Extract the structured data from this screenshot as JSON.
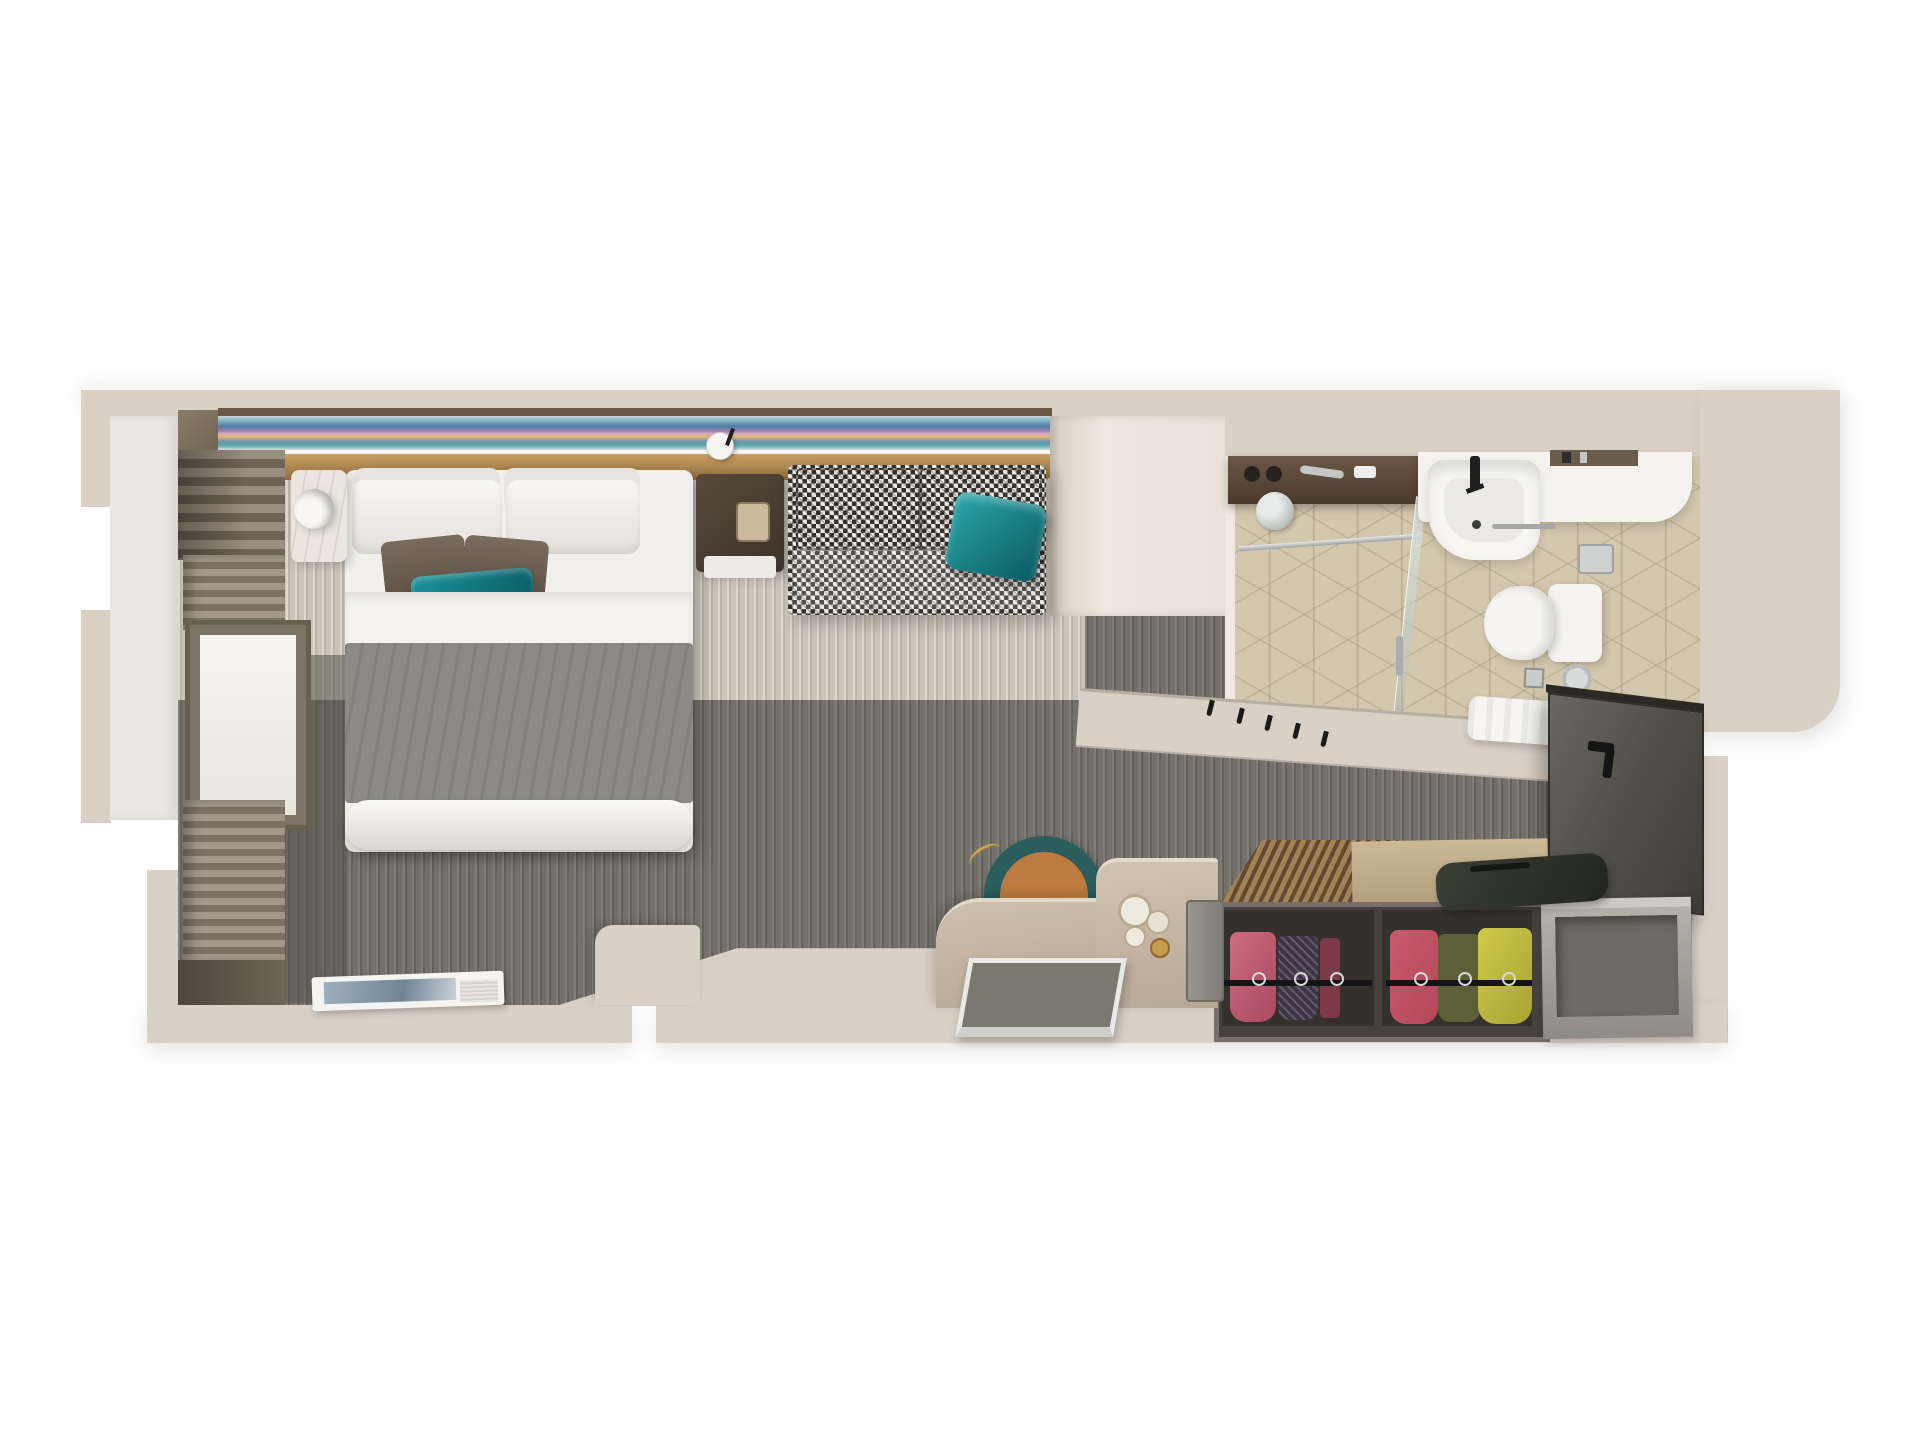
{
  "image_kind": "3d-top-down-floorplan-render",
  "subject": "stateroom-cabin-with-bathroom",
  "palette": {
    "bg": "#ffffff",
    "wall": "#d9d1c6",
    "wall_edge": "#b7aea0",
    "balcony": "#eae8e4",
    "divider": "#e9e2d8",
    "art_trim": "#6b5843",
    "gold_hi": "#c9a166",
    "gold_lo": "#926e3e",
    "art1": "#c8d8dd",
    "art2": "#7fb3c2",
    "art3": "#4f7ea8",
    "art4": "#9b7fb0",
    "art5": "#e3b873",
    "art6": "#58a8a8",
    "carpet_light": "#cbc4b8",
    "carpet_dark": "#74716a",
    "carpet_deep": "#56534c",
    "bed_white": "#f1f0ed",
    "sheet": "#f4f3f0",
    "duvet": "#8b8a86",
    "pillow_shade": "#e7e5e0",
    "accent_hi": "#7a6c5d",
    "accent_lo": "#5f5346",
    "accent_teal_edge": "#10454b",
    "teal_hi": "#18939b",
    "teal_lo": "#0a5860",
    "hound_dark": "#34312d",
    "hound_light": "#eae8e2",
    "wood_dark_hi": "#57493c",
    "wood_dark_lo": "#3e332a",
    "marble": "#ebe7e0",
    "taupe": "#8d8274",
    "curtain_hi": "#a3988a",
    "curtain_lo": "#7d7263",
    "window_frame": "#7d7468",
    "window_glow": "#f6f4ef",
    "tile": "#d3c7ad",
    "fixture": "#f4f3f0",
    "chrome": "#c3c6c4",
    "ink": "#1f1f1f",
    "shelf_wood_hi": "#6a5746",
    "shelf_wood_lo": "#4a3a2c",
    "door_hi": "#6a6661",
    "door_lo": "#3f3d39",
    "wood_floor": "#cf9f6f",
    "slat_hi": "#a18257",
    "slat_lo": "#64492f",
    "wardrobe_frame": "#767068",
    "wardrobe_box": "#44403b",
    "wardrobe_interior": "#34312d",
    "cloth_pink_hi": "#cf6b80",
    "cloth_pink_lo": "#a84a5e",
    "cloth_dark": "#3d3545",
    "cloth_maroon": "#7c3a46",
    "cloth_red": "#b5475a",
    "cloth_olive": "#5d6036",
    "cloth_yellow_hi": "#d1ca4c",
    "cloth_yellow_lo": "#a8a233",
    "rail": "#141317",
    "bench_hi": "#b4b1ab",
    "bench_lo": "#8f8c86",
    "bench_rim": "#cdcac4",
    "bench_inner": "#6e6b67",
    "bag_hi": "#3a3e33",
    "bag_lo": "#22251e",
    "desk_hi": "#cfc0ae",
    "desk_lo": "#b3a391",
    "desk_edge": "#e2d8ca",
    "stool_teal": "#2a5d5c",
    "stool_orange": "#bd7b40",
    "gold_accent": "#caa24e",
    "tray_frame": "#e9e9e7",
    "tray_inner": "#7b786f",
    "step": "#d9d1c5",
    "book_blue_hi": "#9db0c0",
    "book_blue_lo": "#6f8699",
    "towel": "#f6f5f1"
  },
  "scene": {
    "bedroom": [
      "art-headboard-strip",
      "gold-headboard-band",
      "double-bed",
      "white-pillows",
      "accent-pillows",
      "teal-throw-pillows",
      "gray-duvet",
      "marble-nightstand",
      "round-lamp",
      "dark-wood-nightstand",
      "phone",
      "reading-sconce",
      "houndstooth-sofa",
      "teal-sofa-pillow",
      "window",
      "curtains",
      "balcony-strip",
      "floor-book"
    ],
    "bathroom": [
      "shower",
      "toiletry-shelf",
      "shower-head",
      "glass-panel",
      "vanity-counter",
      "sink-black-faucet",
      "wall-niche",
      "toilet",
      "toilet-paper-holder",
      "floor-drain",
      "cube-tile-floor",
      "towel"
    ],
    "entry_area": [
      "coat-hooks",
      "open-closet-door",
      "slatted-wardrobe-top",
      "wardrobe-clothes-rails",
      "hanging-clothes",
      "storage-bench",
      "duffel-bag",
      "wood-entry-floor"
    ],
    "desk_area": [
      "curved-desk",
      "round-stool",
      "wall-mirrors",
      "tablet-panel",
      "metal-tray",
      "floor-step"
    ]
  }
}
